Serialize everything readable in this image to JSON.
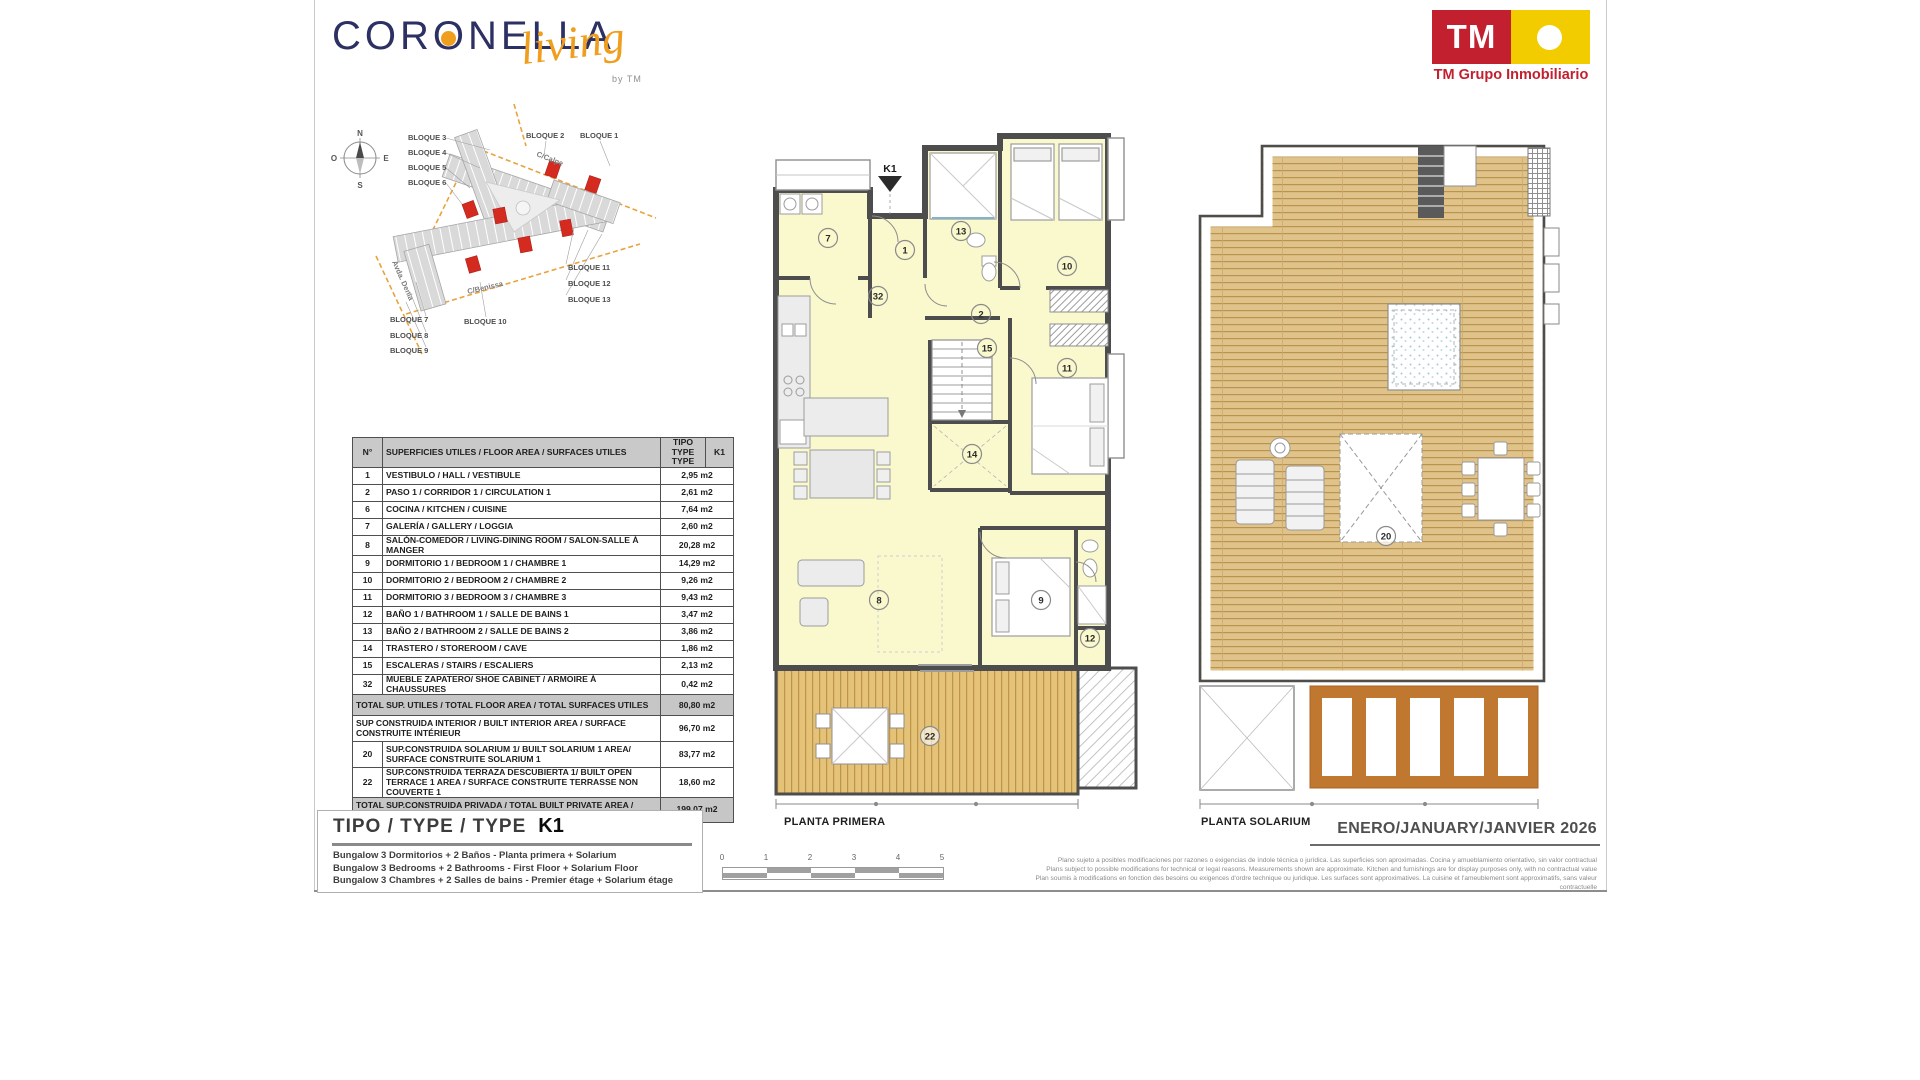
{
  "header": {
    "brand": {
      "part1": "COR",
      "o": "O",
      "part2": "NELLA",
      "script": "living",
      "byline": "by TM"
    },
    "tm": {
      "initials": "TM",
      "caption": "TM Grupo Inmobiliario"
    }
  },
  "colors": {
    "brand_navy": "#2D3063",
    "brand_orange": "#EF9E1E",
    "tm_red": "#C2202F",
    "tm_yellow": "#F3CC00",
    "plan_wall": "#4D4D4D",
    "room_yellow": "#FAF8CD",
    "deck_wood": "#E2C075",
    "solarium_wood": "#DFC38A",
    "pergola_brown": "#C0772F",
    "site_highlight_red": "#D42A20",
    "street_orange": "#E8A33D"
  },
  "site_plan": {
    "compass": {
      "north": "N",
      "south": "S",
      "east": "E",
      "west": "O"
    },
    "streets": [
      "C/Calpe",
      "C/Benissa",
      "Avda. Denia"
    ],
    "block_labels": [
      "BLOQUE 3",
      "BLOQUE 4",
      "BLOQUE 5",
      "BLOQUE 6",
      "BLOQUE 2",
      "BLOQUE 1",
      "BLOQUE 11",
      "BLOQUE 12",
      "BLOQUE 13",
      "BLOQUE 7",
      "BLOQUE 8",
      "BLOQUE 9",
      "BLOQUE 10"
    ]
  },
  "table": {
    "header": {
      "num": "N°",
      "desc": "SUPERFICIES UTILES / FLOOR AREA / SURFACES UTILES",
      "type_col": "TIPO TYPE TYPE",
      "k1_col": "K1"
    },
    "rows": [
      {
        "n": "1",
        "d": "VESTIBULO / HALL  /  VESTIBULE",
        "v": "2,95 m2"
      },
      {
        "n": "2",
        "d": "PASO 1  / CORRIDOR 1  / CIRCULATION 1",
        "v": "2,61 m2"
      },
      {
        "n": "6",
        "d": "COCINA / KITCHEN / CUISINE",
        "v": "7,64 m2"
      },
      {
        "n": "7",
        "d": "GALERÍA / GALLERY / LOGGIA",
        "v": "2,60 m2"
      },
      {
        "n": "8",
        "d": "SALÓN-COMEDOR / LIVING-DINING ROOM / SALON-SALLE À MANGER",
        "v": "20,28 m2"
      },
      {
        "n": "9",
        "d": "DORMITORIO 1 / BEDROOM 1 / CHAMBRE 1",
        "v": "14,29 m2"
      },
      {
        "n": "10",
        "d": "DORMITORIO 2 / BEDROOM 2 / CHAMBRE 2",
        "v": "9,26 m2"
      },
      {
        "n": "11",
        "d": "DORMITORIO 3 / BEDROOM 3 / CHAMBRE 3",
        "v": "9,43 m2"
      },
      {
        "n": "12",
        "d": "BAÑO 1 / BATHROOM 1 / SALLE DE BAINS 1",
        "v": "3,47 m2"
      },
      {
        "n": "13",
        "d": "BAÑO 2 / BATHROOM 2 / SALLE DE BAINS 2",
        "v": "3,86 m2"
      },
      {
        "n": "14",
        "d": "TRASTERO / STOREROOM / CAVE",
        "v": "1,86 m2"
      },
      {
        "n": "15",
        "d": "ESCALERAS / STAIRS / ESCALIERS",
        "v": "2,13 m2"
      },
      {
        "n": "32",
        "d": "MUEBLE ZAPATERO/ SHOE CABINET / ARMOIRE À CHAUSSURES",
        "v": "0,42 m2"
      }
    ],
    "total_utiles": {
      "d": "TOTAL SUP. UTILES / TOTAL FLOOR AREA / TOTAL SURFACES UTILES",
      "v": "80,80 m2"
    },
    "built_rows": [
      {
        "n": "",
        "d": "SUP CONSTRUIDA INTERIOR / BUILT INTERIOR AREA / SURFACE CONSTRUITE INTÉRIEUR",
        "v": "96,70 m2"
      },
      {
        "n": "20",
        "d": "SUP.CONSTRUIDA SOLARIUM 1/ BUILT SOLARIUM 1 AREA/ SURFACE CONSTRUITE SOLARIUM  1",
        "v": "83,77 m2"
      },
      {
        "n": "22",
        "d": "SUP.CONSTRUIDA TERRAZA DESCUBIERTA 1/ BUILT OPEN TERRACE 1 AREA / SURFACE CONSTRUITE TERRASSE NON COUVERTE 1",
        "v": "18,60 m2"
      }
    ],
    "total_built": {
      "d": "TOTAL SUP.CONSTRUIDA PRIVADA / TOTAL  BUILT PRIVATE AREA / TOTAL SURFACE CONSTRUITE PRIVATIVE",
      "v": "199,07 m2"
    }
  },
  "type_box": {
    "title": "TIPO / TYPE / TYPE",
    "code": "K1",
    "lines": [
      "Bungalow 3 Dormitorios + 2 Baños - Planta primera + Solarium",
      "Bungalow 3 Bedrooms + 2 Bathrooms - First Floor + Solarium Floor",
      "Bungalow 3 Chambres + 2 Salles de bains - Premier étage + Solarium étage"
    ]
  },
  "plans": {
    "primera": {
      "label": "PLANTA PRIMERA",
      "unit_marker": "K1",
      "rooms": [
        "7",
        "1",
        "13",
        "10",
        "32",
        "2",
        "15",
        "11",
        "14",
        "8",
        "9",
        "12",
        "22"
      ]
    },
    "solarium": {
      "label": "PLANTA SOLARIUM",
      "rooms": [
        "20"
      ]
    }
  },
  "scale_bar": {
    "ticks": [
      "0",
      "1",
      "2",
      "3",
      "4",
      "5"
    ]
  },
  "footer": {
    "disclaimer": [
      "Plano sujeto a posibles modificaciones por razones o exigencias de índole técnica o jurídica. Las superficies son aproximadas. Cocina y amueblamiento orientativo, sin valor contractual",
      "Plans subject to possible modifications for technical or legal reasons. Measurements shown are approximate. Kitchen and furnishings are for display purposes only, with no contractual value",
      "Plan soumis à modifications en fonction des besoins ou exigences d'ordre technique ou juridique. Les surfaces sont approximatives. La cuisine et l'ameublement sont approximatifs, sans valeur contractuelle"
    ],
    "date": "ENERO/JANUARY/JANVIER 2026"
  }
}
